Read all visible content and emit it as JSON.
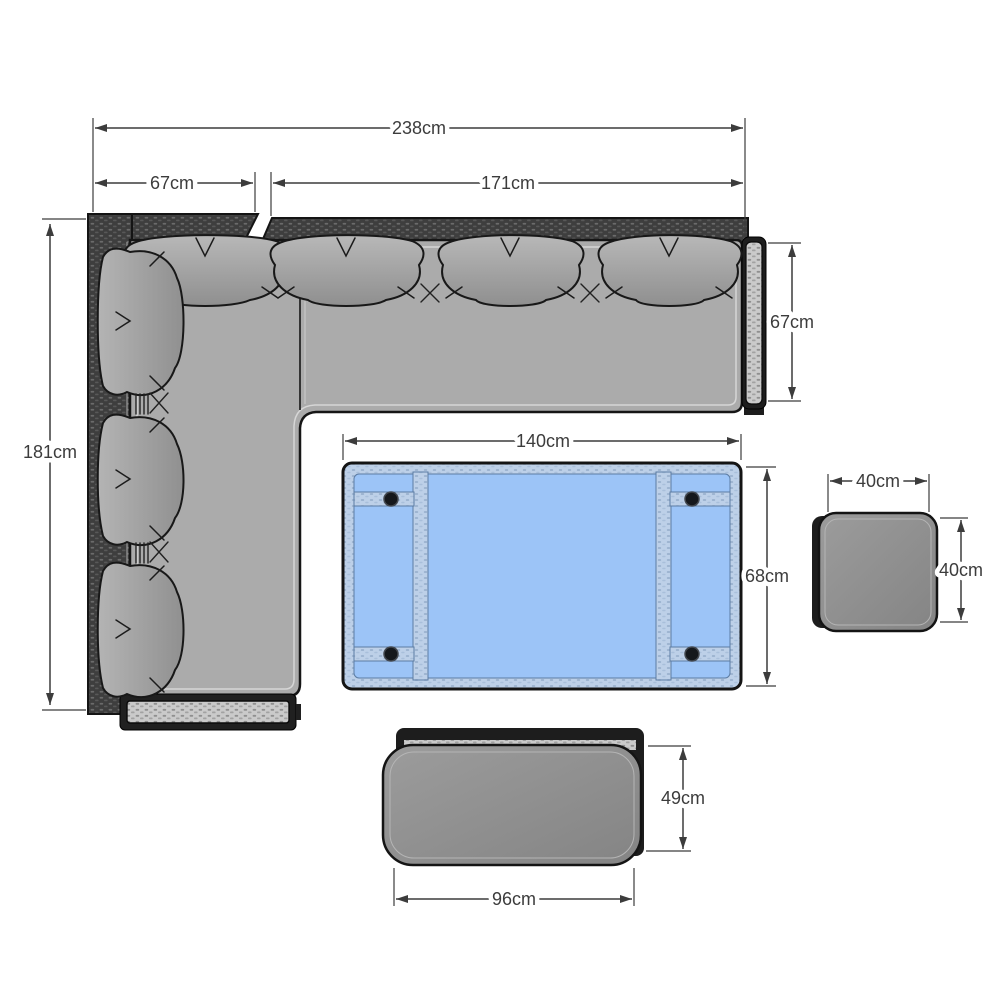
{
  "title": "corner-sofa-dining-set-dimension-diagram",
  "labels": {
    "sofa_total_width": "238cm",
    "sofa_left_arm_width": "67cm",
    "sofa_right_section_width": "171cm",
    "sofa_left_section_depth": "181cm",
    "sofa_right_section_depth": "67cm",
    "table_width": "140cm",
    "table_depth": "68cm",
    "stool_width": "40cm",
    "stool_depth": "40cm",
    "bench_depth": "49cm",
    "bench_width": "96cm"
  },
  "components": {
    "corner_sofa": "L-shaped rattan corner sofa with grey cushions and scatter pillows, top view",
    "dining_table": "rectangular table with blue glass top showing frame rails and fixing knobs",
    "stool": "square rattan stool with grey cushion",
    "bench": "rattan bench with grey cushion"
  },
  "colors": {
    "background": "#ffffff",
    "dimension_lines": "#3c3c3c",
    "sofa_weave_dark": "#3e3e3e",
    "sofa_weave_light": "#cacaca",
    "sofa_cushion": "#ababab",
    "pillow": "#a2a2a2",
    "table_glass": "#9cc4f7",
    "table_frame": "#bdd0e8",
    "bench_cushion": "#949494",
    "outline": "#141414"
  }
}
